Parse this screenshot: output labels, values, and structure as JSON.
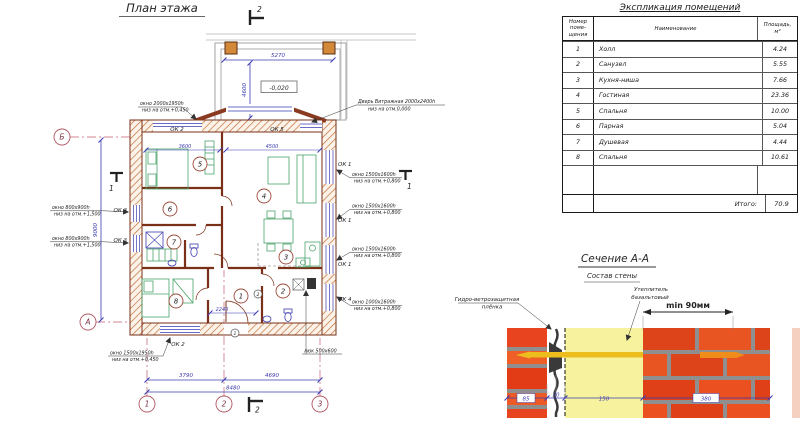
{
  "plan": {
    "title": "План этажа",
    "axis": {
      "a": "А",
      "b": "Б",
      "c1": "1",
      "c2": "2",
      "c3": "3"
    },
    "marks": {
      "top": "2",
      "bottom": "2",
      "left": "1",
      "right": "1"
    },
    "elevation": "-0,020",
    "room_numbers": [
      "1",
      "2",
      "3",
      "4",
      "5",
      "6",
      "7",
      "8"
    ],
    "door_tags": [
      "1",
      "2"
    ],
    "ok": {
      "ok1": "ОК 1",
      "ok2": "ОК 2",
      "ok3": "ОК 3",
      "ok4": "ОК 4",
      "ok5": "ОК 5"
    },
    "labels": {
      "win2000_1": "окно 2000х1950h",
      "win2000_2": "низ на отм.+0,450",
      "win800_1": "окно 800х900h",
      "win800_2": "низ на отм.+1,500",
      "win1500w_1": "окно 1500х1950h",
      "win1500w_2": "низ на отм.+0,450",
      "win1500_1": "окно 1500х1600h",
      "win1500_2": "низ на отм.+0,800",
      "win1000_1": "окно 1000х1600h",
      "win1000_2": "низ на отм.+0,800",
      "door_1": "Дверь Витражная 2000х2400h",
      "door_2": "низ на отм.0,000",
      "hatch": "люк 500х600"
    },
    "dims": {
      "w5270": "5270",
      "w4600": "4600",
      "w9000": "9000",
      "w3790": "3790",
      "w4690": "4690",
      "w8480": "8480",
      "w3600": "3600",
      "w4500": "4500",
      "w2240": "2240"
    }
  },
  "table": {
    "title": "Экспликация помещений",
    "head": {
      "num1": "Номер",
      "num2": "поме-",
      "num3": "щения",
      "name": "Наименование",
      "area1": "Площадь,",
      "area2": "м²"
    },
    "rows": [
      {
        "num": "1",
        "name": "Холл",
        "area": "4.24"
      },
      {
        "num": "2",
        "name": "Санузел",
        "area": "5.55"
      },
      {
        "num": "3",
        "name": "Кухня-ниша",
        "area": "7.66"
      },
      {
        "num": "4",
        "name": "Гостиная",
        "area": "23.36"
      },
      {
        "num": "5",
        "name": "Спальня",
        "area": "10.00"
      },
      {
        "num": "6",
        "name": "Парная",
        "area": "5.04"
      },
      {
        "num": "7",
        "name": "Душевая",
        "area": "4.44"
      },
      {
        "num": "8",
        "name": "Спальня",
        "area": "10.61"
      }
    ],
    "total_label": "Итого:",
    "total_value": "70.9"
  },
  "section": {
    "title": "Сечение А-А",
    "subtitle": "Состав стены",
    "film_1": "Гидро-ветрозащитная",
    "film_2": "плёнка",
    "ins_1": "Утеплитель",
    "ins_2": "базальтовый",
    "min": "min 90мм",
    "dims": {
      "d85": "85",
      "d30": "30",
      "d150": "150",
      "d380": "380"
    }
  },
  "colors": {
    "dim_blue": "#3b3bb0",
    "hatch_orange": "#c2672b",
    "brick_red": "#e04018",
    "insulation_yellow": "#f7f29d",
    "axis_pink": "#c06070"
  }
}
